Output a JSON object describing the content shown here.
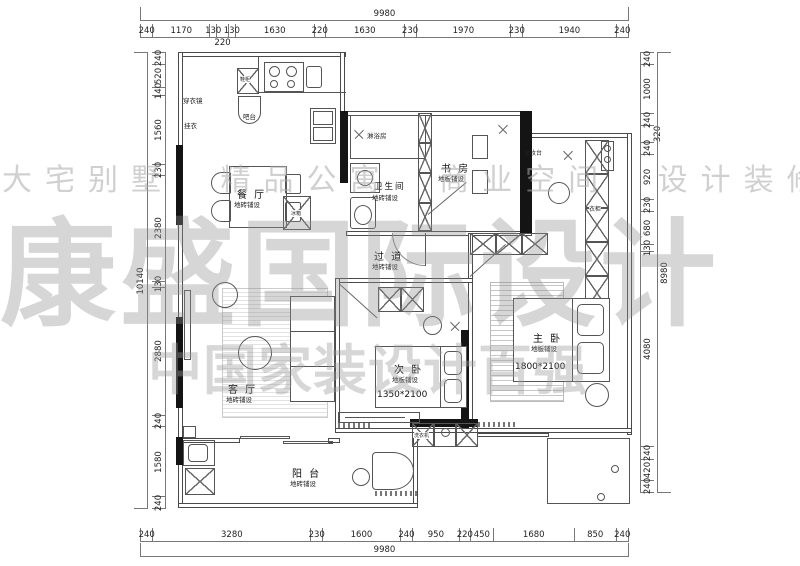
{
  "watermarks": {
    "row_top": "大宅别墅 精品公寓 商业空间 设计装修",
    "brand_large": "康盛国际设计",
    "row_bottom": "中国家装设计百强"
  },
  "dims": {
    "top": {
      "total": "9980",
      "segments": [
        "240",
        "1170",
        "130",
        "220",
        "130",
        "1630",
        "220",
        "1630",
        "230",
        "1970",
        "230",
        "1940",
        "240"
      ]
    },
    "bottom": {
      "total": "9980",
      "segments": [
        "240",
        "3280",
        "230",
        "1600",
        "240",
        "950",
        "220",
        "450",
        "1680",
        "850",
        "240"
      ]
    },
    "left": {
      "total": "10140",
      "segments": [
        "240",
        "520",
        "140",
        "1560",
        "230",
        "2380",
        "130",
        "2880",
        "240",
        "1580",
        "240"
      ]
    },
    "right": {
      "total": "8980",
      "segments": [
        "240",
        "1000",
        "240",
        "320",
        "240",
        "920",
        "230",
        "680",
        "130",
        "4080",
        "240",
        "420",
        "240"
      ]
    }
  },
  "rooms": {
    "dining": {
      "title": "餐 厅",
      "sub": "地砖铺设"
    },
    "bathroom": {
      "title": "卫生间",
      "sub": "地砖铺设"
    },
    "study": {
      "title": "书 房",
      "sub": "地板铺设"
    },
    "corridor": {
      "title": "过 道",
      "sub": "地砖铺设"
    },
    "living": {
      "title": "客 厅",
      "sub": "地砖铺设"
    },
    "bedroom2": {
      "title": "次 卧",
      "sub": "地板铺设",
      "bed_size": "1350*2100"
    },
    "master": {
      "title": "主 卧",
      "sub": "地板铺设",
      "bed_size": "1800*2100"
    },
    "balcony": {
      "title": "阳 台",
      "sub": "地砖铺设"
    }
  },
  "fixtures": {
    "dressing_mirror": "穿衣镜",
    "coat_hook": "挂衣",
    "shoe_cabinet": "鞋柜",
    "bar_counter": "吧台",
    "shower_room": "淋浴房",
    "fridge": "冰箱",
    "dresser": "化妆台",
    "wardrobe": "衣柜",
    "washing_machine": "洗衣机"
  },
  "colors": {
    "wall": "#141414",
    "line": "#4a4a4a",
    "watermark": "#9c9c9c"
  }
}
